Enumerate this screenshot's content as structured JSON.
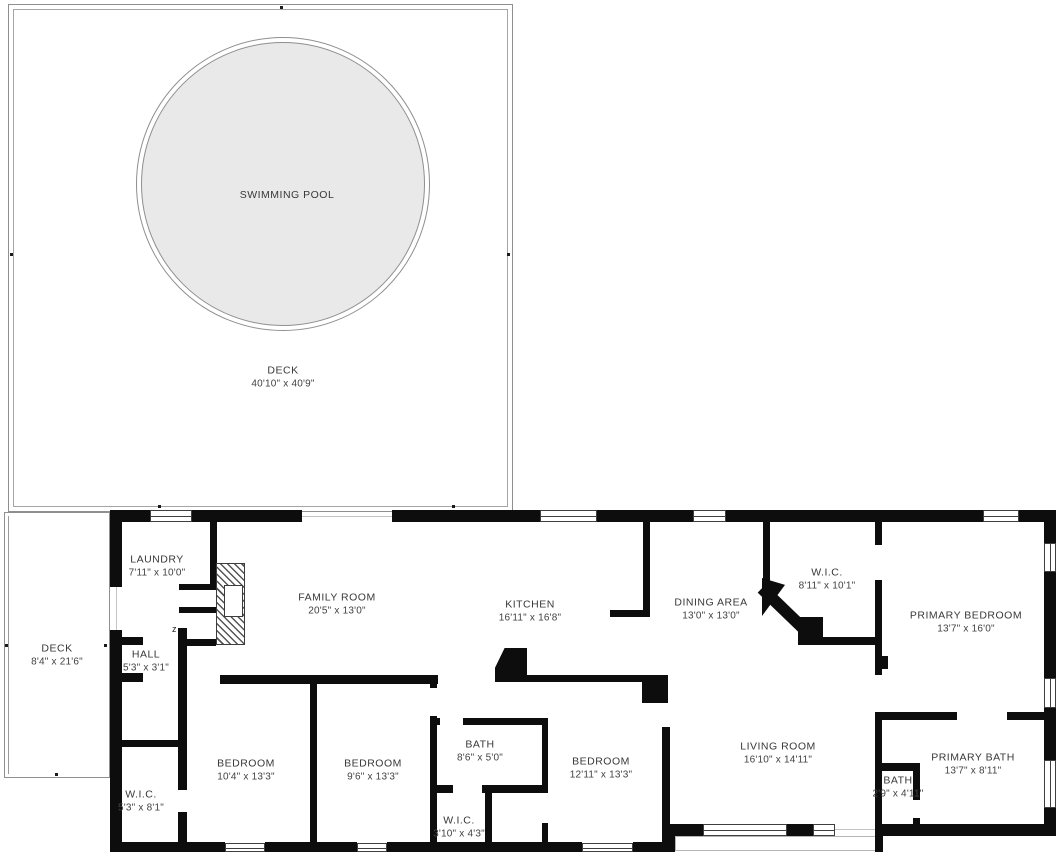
{
  "floorplan": {
    "door_marker": "z",
    "rooms": [
      {
        "id": "swimming-pool",
        "name": "SWIMMING POOL",
        "dims": "",
        "x": 287,
        "y": 195
      },
      {
        "id": "pool-deck",
        "name": "DECK",
        "dims": "40'10\" x 40'9\"",
        "x": 283,
        "y": 377
      },
      {
        "id": "laundry",
        "name": "LAUNDRY",
        "dims": "7'11\" x 10'0\"",
        "x": 157,
        "y": 566
      },
      {
        "id": "family-room",
        "name": "FAMILY ROOM",
        "dims": "20'5\" x 13'0\"",
        "x": 337,
        "y": 604
      },
      {
        "id": "kitchen",
        "name": "KITCHEN",
        "dims": "16'11\" x 16'8\"",
        "x": 530,
        "y": 611
      },
      {
        "id": "dining-area",
        "name": "DINING AREA",
        "dims": "13'0\" x 13'0\"",
        "x": 711,
        "y": 609
      },
      {
        "id": "wic-primary",
        "name": "W.I.C.",
        "dims": "8'11\" x 10'1\"",
        "x": 827,
        "y": 579
      },
      {
        "id": "primary-bedroom",
        "name": "PRIMARY BEDROOM",
        "dims": "13'7\" x 16'0\"",
        "x": 966,
        "y": 622
      },
      {
        "id": "side-deck",
        "name": "DECK",
        "dims": "8'4\" x 21'6\"",
        "x": 57,
        "y": 655
      },
      {
        "id": "hall",
        "name": "HALL",
        "dims": "5'3\" x 3'1\"",
        "x": 146,
        "y": 661
      },
      {
        "id": "wic-left",
        "name": "W.I.C.",
        "dims": "5'3\" x 8'1\"",
        "x": 141,
        "y": 801
      },
      {
        "id": "bedroom-1",
        "name": "BEDROOM",
        "dims": "10'4\" x 13'3\"",
        "x": 246,
        "y": 770
      },
      {
        "id": "bedroom-2",
        "name": "BEDROOM",
        "dims": "9'6\" x 13'3\"",
        "x": 373,
        "y": 770
      },
      {
        "id": "hall-bath",
        "name": "BATH",
        "dims": "8'6\" x 5'0\"",
        "x": 480,
        "y": 751
      },
      {
        "id": "wic-small",
        "name": "W.I.C.",
        "dims": "3'10\" x 4'3\"",
        "x": 459,
        "y": 827
      },
      {
        "id": "bedroom-3",
        "name": "BEDROOM",
        "dims": "12'11\" x 13'3\"",
        "x": 601,
        "y": 768
      },
      {
        "id": "living-room",
        "name": "LIVING ROOM",
        "dims": "16'10\" x 14'11\"",
        "x": 778,
        "y": 753
      },
      {
        "id": "primary-bath",
        "name": "PRIMARY BATH",
        "dims": "13'7\" x 8'11\"",
        "x": 973,
        "y": 764
      },
      {
        "id": "small-bath",
        "name": "BATH",
        "dims": "2'9\" x 4'11\"",
        "x": 898,
        "y": 787
      }
    ]
  },
  "colors": {
    "wall": "#0d0d0d",
    "pool_fill": "#e9e9e9",
    "outline": "#8f8f8f",
    "text": "#383838"
  }
}
